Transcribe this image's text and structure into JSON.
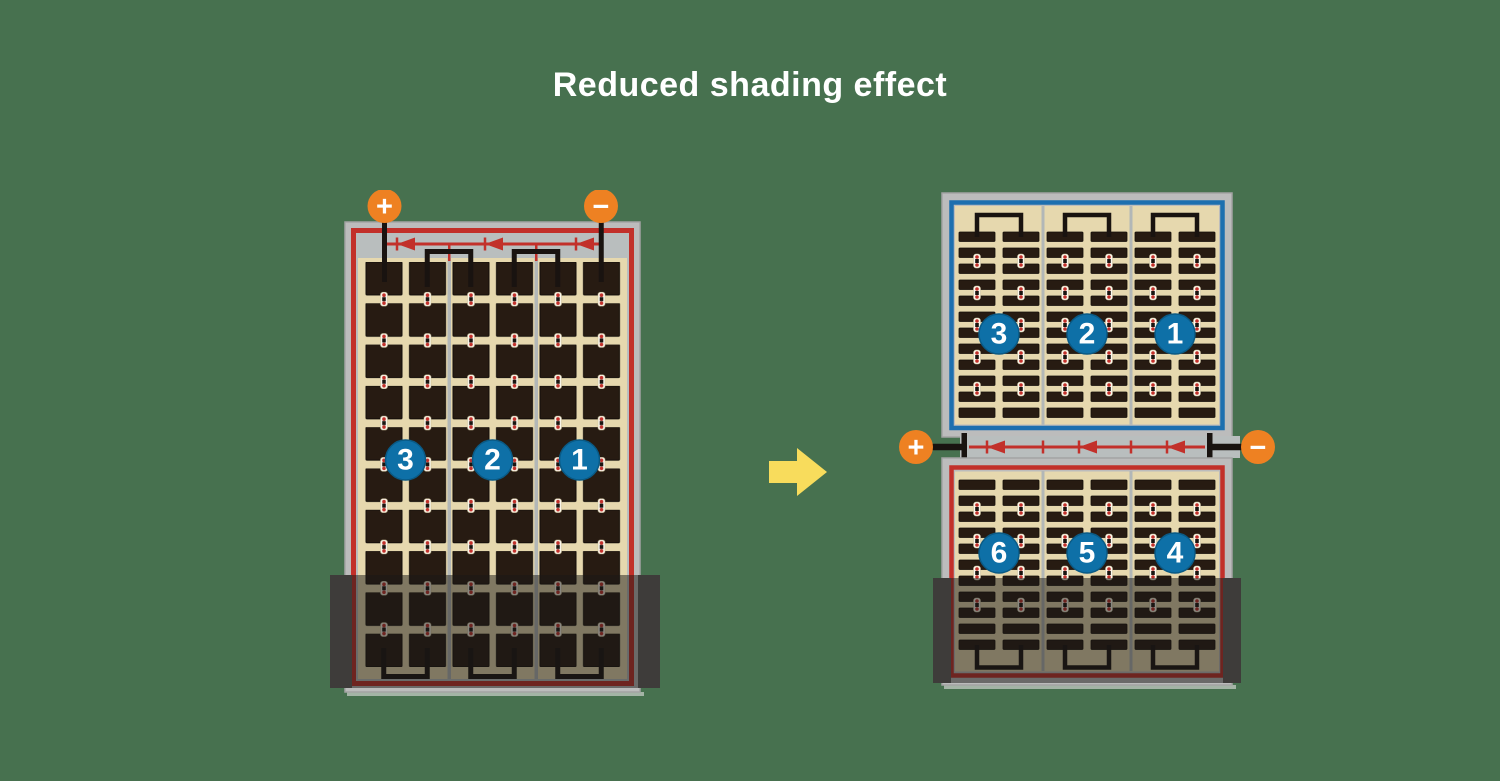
{
  "title": "Reduced shading effect",
  "left_panel": {
    "terminals": {
      "positive": "+",
      "negative": "−"
    },
    "sections": [
      "3",
      "2",
      "1"
    ]
  },
  "right_panel": {
    "terminals": {
      "positive": "+",
      "negative": "−"
    },
    "top_sections": [
      "3",
      "2",
      "1"
    ],
    "bottom_sections": [
      "6",
      "5",
      "4"
    ]
  },
  "icons": {
    "plus_terminal": "plus-terminal-icon",
    "minus_terminal": "minus-terminal-icon",
    "diode": "diode-left-icon",
    "transition": "right-arrow-icon"
  },
  "colors": {
    "background": "#47714F",
    "title_text": "#FFFFFF",
    "panel_frame_gray": "#BCBCBC",
    "panel_inner_gray": "#B9BEBE",
    "cell_background_tan": "#E6D8AE",
    "cell_dark": "#271B12",
    "wire_red": "#C2302A",
    "wire_blue": "#1D6FAF",
    "wire_black": "#191310",
    "terminal_orange": "#EE8122",
    "section_circle_blue": "#0E70A7",
    "arrow_yellow": "#F8DC5C",
    "shade_cap": "#3E3C3A"
  }
}
